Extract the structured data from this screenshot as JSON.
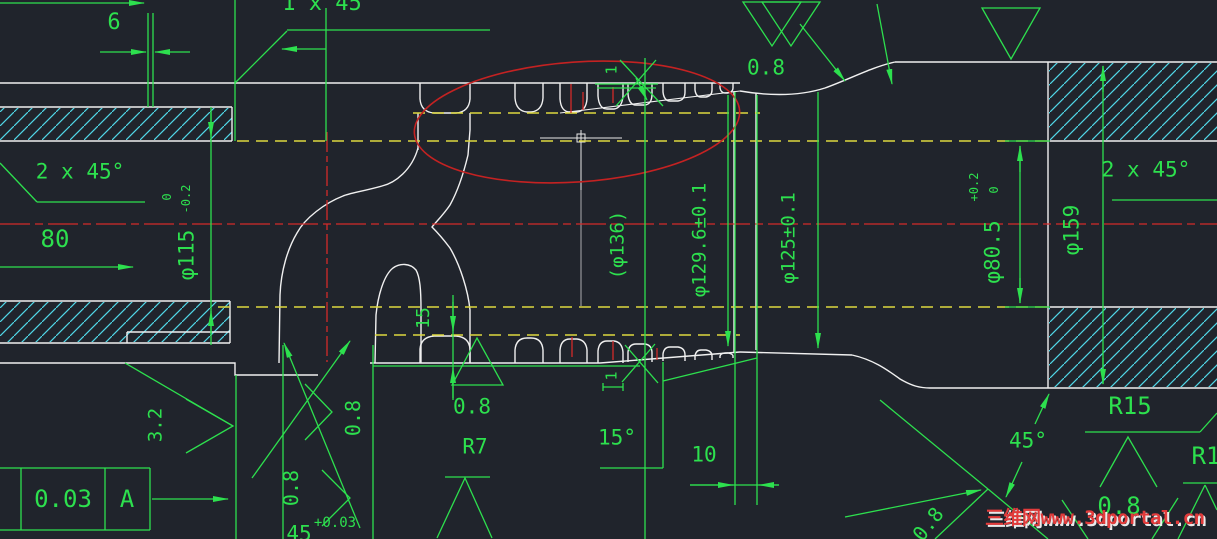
{
  "drawing": {
    "type": "cad-shaft-section-drawing",
    "background": "#20242c",
    "colors": {
      "geometry": "#f0f0f0",
      "dimension_green": "#2de04e",
      "hatch_cyan": "#50d7e8",
      "centerline_red": "#d42a2a",
      "phantom_yellow": "#ddd83f",
      "highlight_ellipse_red": "#c42222",
      "watermark_red": "#e23b3b"
    },
    "feature_control_frame": {
      "tolerance": "0.03",
      "datum": "A"
    },
    "labels": {
      "dim_6": "6",
      "chamfer_top": "1 x 45",
      "chamfer_left": "2 x 45°",
      "dim_80": "80",
      "dia_115": "φ115",
      "tol_115_hi": "0",
      "tol_115_lo": "-0.2",
      "dia_136": "(φ136)",
      "dia_129_6": "φ129.6±0.1",
      "dia_125": "φ125±0.1",
      "rough_top": "0.8",
      "dia_80_5": "φ80.5",
      "tol_80_5_hi": "+0.2",
      "tol_80_5_lo": "0",
      "dia_159": "φ159",
      "chamfer_right": "2 x 45°",
      "r15": "R15",
      "angle_45": "45°",
      "r1": "R1",
      "rough_br": "0.8",
      "rough_diag": "0.8",
      "r7": "R7",
      "rough_mid": "0.8",
      "angle_15": "15°",
      "dim_10": "10",
      "dim_15": "15",
      "dim_1_top": "1",
      "dim_1_bot": "1",
      "rough_3_2": "3.2",
      "rough_rot1": "0.8",
      "rough_rot2": "0.8",
      "dim_45": "45",
      "tol_45": "+0.03",
      "fcf_tol": "0.03",
      "fcf_datum": "A",
      "watermark": "三维网www.3dportal.cn"
    }
  }
}
